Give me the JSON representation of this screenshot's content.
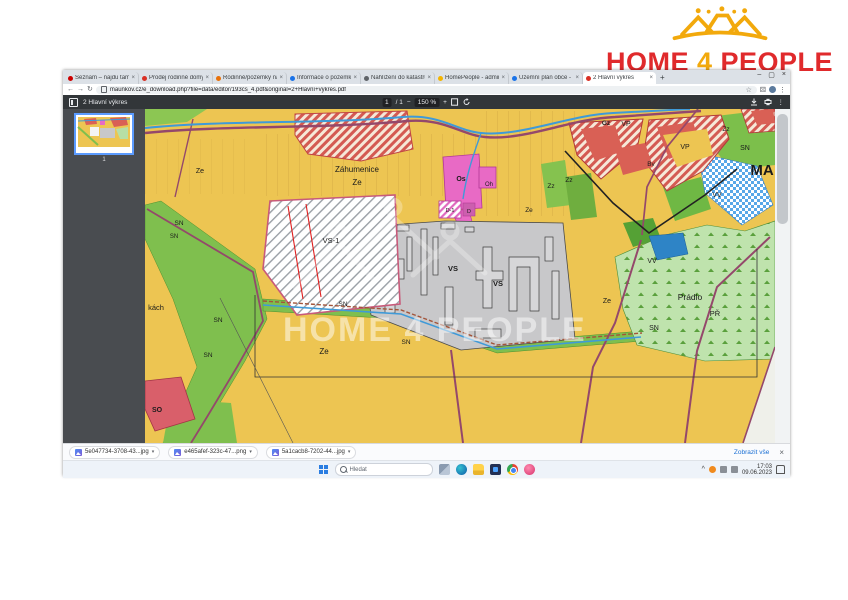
{
  "logo": {
    "home": "HOME",
    "four": "4",
    "people": "PEOPLE",
    "red": "#e02a2c",
    "gold": "#f2a90c"
  },
  "browser": {
    "tabs": [
      {
        "label": "Seznam – najdu tam, co nezn",
        "fav": "#cc0000"
      },
      {
        "label": "Prodej rodinné domy 80m, Bradčice",
        "fav": "#d93025"
      },
      {
        "label": "Rodinné/pozemky na prodej 2",
        "fav": "#e8710a"
      },
      {
        "label": "Informace o pozemku | Nahlíže",
        "fav": "#1a73e8"
      },
      {
        "label": "Nahlížení do katastru nemovito",
        "fav": "#5f6368"
      },
      {
        "label": "HomePeople - administrace",
        "fav": "#f4b400"
      },
      {
        "label": "Územní plán obce - Oficiální st",
        "fav": "#1a73e8"
      },
      {
        "label": "2 Hlavní výkres",
        "fav": "#d93025",
        "active": true
      }
    ],
    "new_tab": "+",
    "window_controls": {
      "minimize": "–",
      "maximize": "▢",
      "close": "×"
    },
    "nav": {
      "back": "←",
      "forward": "→",
      "reload": "↻"
    },
    "address": {
      "url": "maunkov.cz/e_download.php?file=data/editor/193cs_4.pdf&original=2+Hlavní+výkres.pdf"
    },
    "icons": {
      "star": "☆",
      "kebab": "⋮",
      "puzzle": "⚄"
    }
  },
  "pdf_viewer": {
    "title": "2 Hlavní výkres",
    "page_current": "1",
    "page_total": "/ 1",
    "zoom_out": "−",
    "zoom_level": "150 %",
    "zoom_in": "+",
    "thumbnail_page_number": "1"
  },
  "map": {
    "watermark": "HOME 4 PEOPLE",
    "labels": [
      {
        "t": "Záhumenice",
        "x": 212,
        "y": 63,
        "s": 8
      },
      {
        "t": "Ze",
        "x": 212,
        "y": 76,
        "s": 8
      },
      {
        "t": "Ze",
        "x": 55,
        "y": 64,
        "s": 7
      },
      {
        "t": "Os",
        "x": 316,
        "y": 72,
        "s": 7,
        "b": 1
      },
      {
        "t": "Oh",
        "x": 344,
        "y": 77,
        "s": 6
      },
      {
        "t": "Zz",
        "x": 406,
        "y": 79,
        "s": 6.5
      },
      {
        "t": "Zz",
        "x": 424,
        "y": 73,
        "s": 6.5
      },
      {
        "t": "Ze",
        "x": 384,
        "y": 103,
        "s": 6.5
      },
      {
        "t": "Gz",
        "x": 461,
        "y": 16,
        "s": 6.5,
        "b": 1
      },
      {
        "t": "VP",
        "x": 481,
        "y": 17,
        "s": 7
      },
      {
        "t": "VP",
        "x": 540,
        "y": 40,
        "s": 7
      },
      {
        "t": "Bv",
        "x": 506,
        "y": 57,
        "s": 6.5
      },
      {
        "t": "Zz",
        "x": 581,
        "y": 22,
        "s": 6.5
      },
      {
        "t": "SN",
        "x": 600,
        "y": 41,
        "s": 7
      },
      {
        "t": "MA",
        "x": 617,
        "y": 66,
        "s": 15,
        "b": 1
      },
      {
        "t": "SN",
        "x": 34,
        "y": 116,
        "s": 6.5
      },
      {
        "t": "SN",
        "x": 29,
        "y": 129,
        "s": 6
      },
      {
        "t": "VS-1",
        "x": 186,
        "y": 134,
        "s": 7.5
      },
      {
        "t": "VS",
        "x": 308,
        "y": 162,
        "s": 7.5,
        "b": 1
      },
      {
        "t": "VS",
        "x": 353,
        "y": 177,
        "s": 7.5,
        "b": 1
      },
      {
        "t": "VV",
        "x": 507,
        "y": 154,
        "s": 7
      },
      {
        "t": "VV",
        "x": 572,
        "y": 88,
        "s": 7
      },
      {
        "t": "Prádlo",
        "x": 545,
        "y": 191,
        "s": 8.5
      },
      {
        "t": "PŘ",
        "x": 570,
        "y": 207,
        "s": 7.5
      },
      {
        "t": "SN",
        "x": 509,
        "y": 221,
        "s": 7
      },
      {
        "t": "Ze",
        "x": 462,
        "y": 194,
        "s": 7
      },
      {
        "t": "SN",
        "x": 198,
        "y": 197,
        "s": 6.5
      },
      {
        "t": "SN",
        "x": 261,
        "y": 235,
        "s": 6.5
      },
      {
        "t": "SN",
        "x": 73,
        "y": 213,
        "s": 6.5
      },
      {
        "t": "SN",
        "x": 63,
        "y": 248,
        "s": 6.5
      },
      {
        "t": "kách",
        "x": 11,
        "y": 201,
        "s": 7.5
      },
      {
        "t": "Ze",
        "x": 179,
        "y": 245,
        "s": 8
      },
      {
        "t": "SO",
        "x": 12,
        "y": 303,
        "s": 7,
        "b": 1
      },
      {
        "t": "D-1",
        "x": 305,
        "y": 103,
        "s": 5.5
      },
      {
        "t": "D",
        "x": 324,
        "y": 104,
        "s": 5.5
      }
    ]
  },
  "downloads": {
    "files": [
      {
        "name": "5e047734-3708-43...jpg"
      },
      {
        "name": "e465afef-323c-47...png"
      },
      {
        "name": "5a1cacb8-7202-44...jpg"
      }
    ],
    "caret": "▾",
    "show_all": "Zobrazit vše",
    "close": "×"
  },
  "taskbar": {
    "search_placeholder": "Hledat",
    "tray_chevron": "^",
    "time": "17:03",
    "date": "09.06.2023"
  }
}
